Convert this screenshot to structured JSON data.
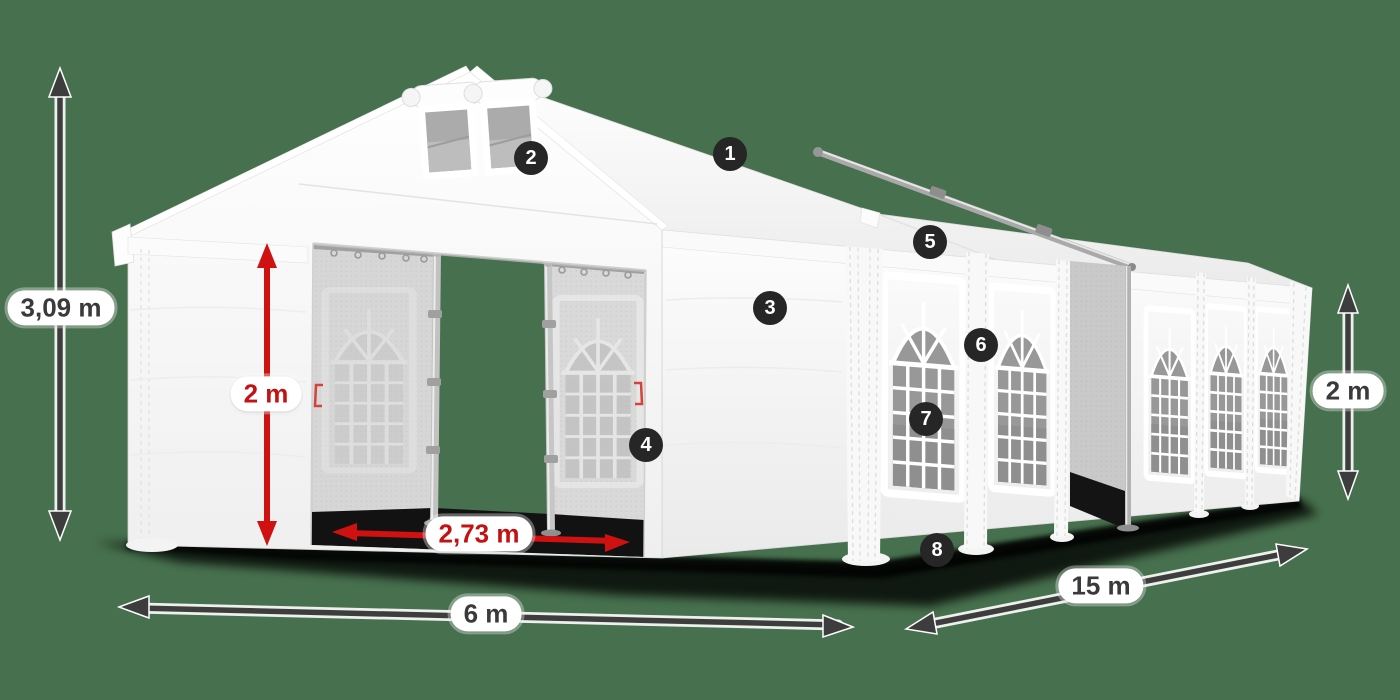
{
  "colors": {
    "background": "#47714E",
    "tent_white": "#FFFFFF",
    "accent_red": "#C41111",
    "arrow_dark": "#3D3D3D",
    "badge_bg": "#262626",
    "badge_text": "#FFFFFF",
    "label_bg": "#FFFFFF",
    "label_text": "#3A3A3A",
    "window_glass": "#989898",
    "interior_gray": "#D6D6D6"
  },
  "dimensions": [
    {
      "id": "total-height",
      "label": "3,09 m",
      "style": "dark",
      "orientation": "vertical"
    },
    {
      "id": "door-height",
      "label": "2 m",
      "style": "red",
      "orientation": "vertical"
    },
    {
      "id": "door-width",
      "label": "2,73 m",
      "style": "red",
      "orientation": "horizontal"
    },
    {
      "id": "front-width",
      "label": "6 m",
      "style": "dark",
      "orientation": "horizontal"
    },
    {
      "id": "side-length",
      "label": "15 m",
      "style": "dark",
      "orientation": "diagonal"
    },
    {
      "id": "wall-height",
      "label": "2 m",
      "style": "dark",
      "orientation": "vertical"
    }
  ],
  "callouts": [
    {
      "number": "1"
    },
    {
      "number": "2"
    },
    {
      "number": "3"
    },
    {
      "number": "4"
    },
    {
      "number": "5"
    },
    {
      "number": "6"
    },
    {
      "number": "7"
    },
    {
      "number": "8"
    }
  ]
}
